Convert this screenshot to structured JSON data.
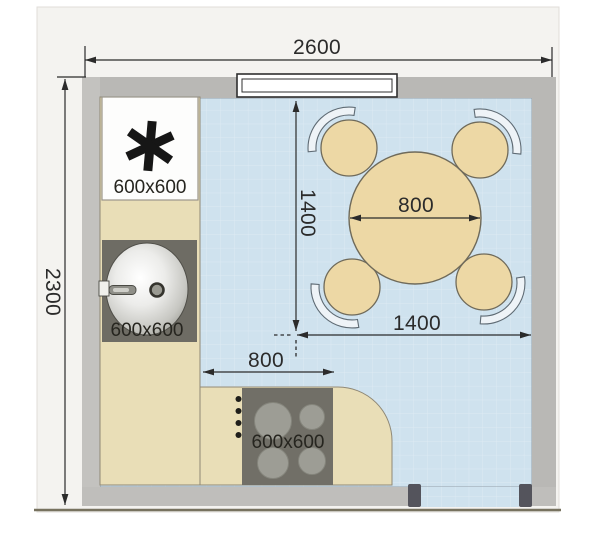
{
  "plan": {
    "type": "kitchen-floor-plan",
    "view": "top-down"
  },
  "dims": {
    "room_width": "2600",
    "room_depth": "2300",
    "dining_zone_width": "1400",
    "dining_zone_depth": "1400",
    "table_diameter": "800",
    "passage_width": "800"
  },
  "appliances": {
    "refrigerator": {
      "size": "600x600",
      "symbol": "asterisk"
    },
    "sink": {
      "size": "600x600"
    },
    "cooktop": {
      "size": "600x600",
      "burners": 4
    }
  },
  "furniture": {
    "dining_table": {
      "shape": "round",
      "chairs": 4
    }
  },
  "palette": {
    "floor_blue": "#cfe2ee",
    "floor_grid": "#ddeaf3",
    "wall_gray": "#b9b8b5",
    "counter_beige": "#e9deb7",
    "furniture_tan": "#edd8a5",
    "appliance_dark": "#6e6c64",
    "burner_gray": "#9d9d95",
    "door_jamb": "#54545c",
    "dimension_ink": "#2b2b2b",
    "photo_background": "#f4f3f0",
    "photo_edge": "#77725f"
  }
}
